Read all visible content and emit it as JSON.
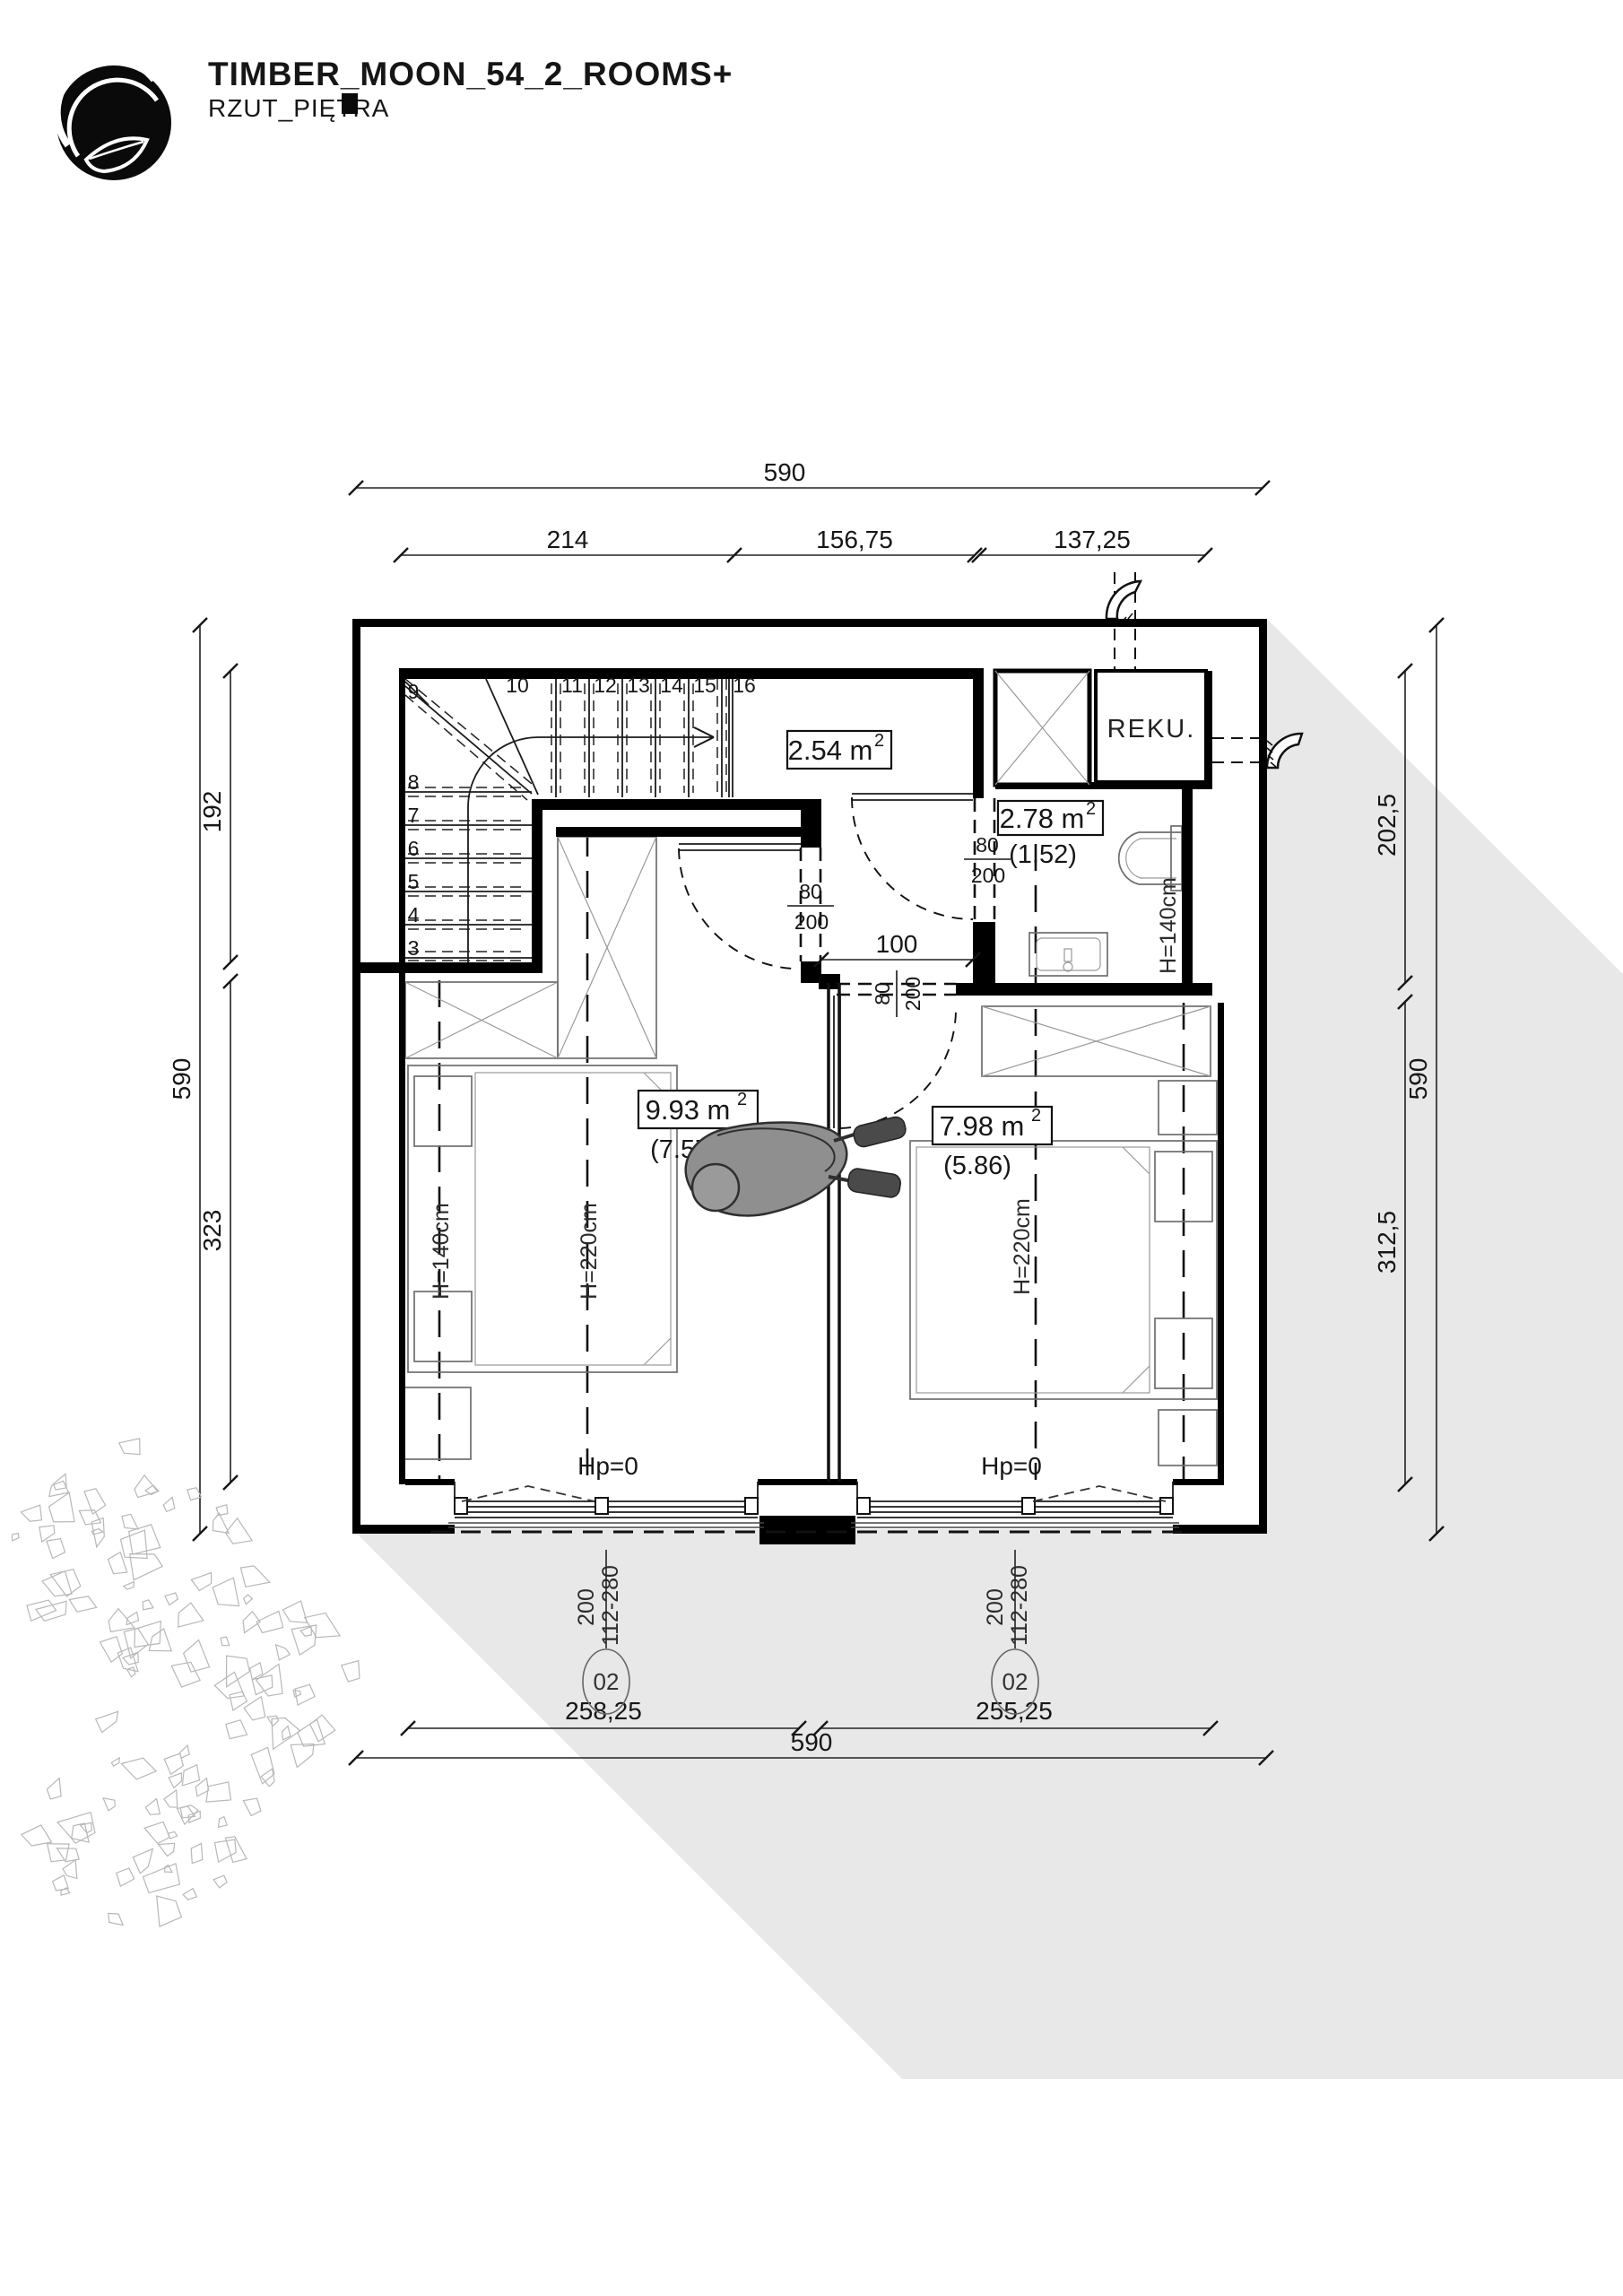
{
  "header": {
    "title": "TIMBER_MOON_54_2_ROOMS+",
    "subtitle": "RZUT_PIĘTRA"
  },
  "dimensions": {
    "top": {
      "total": "590",
      "seg1": "214",
      "seg2": "156,75",
      "seg3": "137,25"
    },
    "left": {
      "total": "590",
      "seg1": "192",
      "seg2": "323"
    },
    "right": {
      "total": "590",
      "seg1": "202,5",
      "seg2": "312,5"
    },
    "bottom": {
      "total": "590",
      "seg1": "258,25",
      "seg2": "255,25"
    }
  },
  "rooms": {
    "hall": {
      "area": "2.54 m",
      "sup": "2"
    },
    "bathroom": {
      "area": "2.78 m",
      "sup": "2",
      "net": "(1.52)",
      "height": "H=140cm"
    },
    "bedroom_left": {
      "area": "9.93 m",
      "sup": "2",
      "net": "(7.57)",
      "height_low": "H=140cm",
      "height_high": "H=220cm",
      "floor": "Hp=0"
    },
    "bedroom_right": {
      "area": "7.98 m",
      "sup": "2",
      "net": "(5.86)",
      "height_high": "H=220cm",
      "floor": "Hp=0"
    }
  },
  "equipment": {
    "reku": "REKU."
  },
  "doors": {
    "bedroom_left": {
      "w": "80",
      "h": "200"
    },
    "bathroom": {
      "w": "80",
      "h": "200"
    },
    "bedroom_right": {
      "w": "80",
      "h": "200"
    },
    "passage": "100"
  },
  "windows": {
    "left": {
      "width": "200",
      "range": "112-280",
      "tag": "02"
    },
    "right": {
      "width": "200",
      "range": "112-280",
      "tag": "02"
    }
  },
  "stairs": {
    "numbers": [
      "3",
      "4",
      "5",
      "6",
      "7",
      "8",
      "9",
      "10",
      "11",
      "12",
      "13",
      "14",
      "15",
      "16"
    ]
  },
  "colors": {
    "wall": "#000000",
    "shadow": "#e8e8e8",
    "furniture_line": "#6e6e6e",
    "tree_line": "#b8b8b8",
    "person_fill": "#8f8f8f"
  }
}
